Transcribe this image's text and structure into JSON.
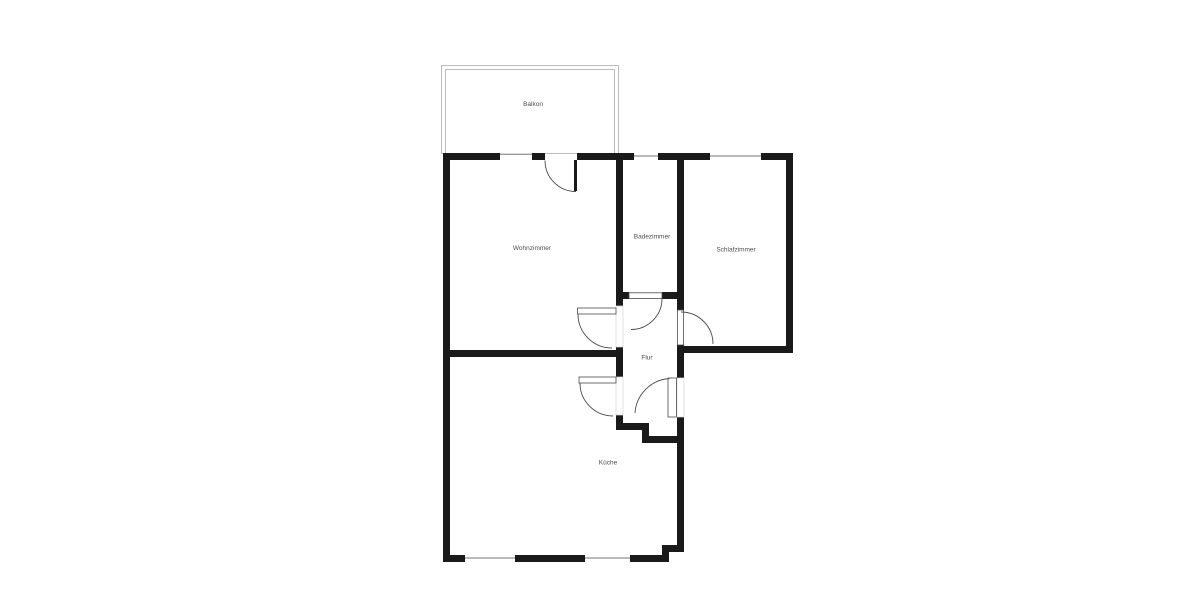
{
  "rooms": [
    {
      "id": "balkon",
      "label": "Balkon"
    },
    {
      "id": "wohnzimmer",
      "label": "Wohnzimmer"
    },
    {
      "id": "badezimmer",
      "label": "Badezimmer"
    },
    {
      "id": "schlafzimmer",
      "label": "Schlafzimmer"
    },
    {
      "id": "flur",
      "label": "Flur"
    },
    {
      "id": "kueche",
      "label": "Küche"
    }
  ],
  "colors": {
    "wall": "#1a1a1a",
    "window": "#9c9c9c",
    "door": "#4b4b4b",
    "balcony": "#bdbdbd",
    "label": "#4d4d4d",
    "background": "#ffffff"
  }
}
